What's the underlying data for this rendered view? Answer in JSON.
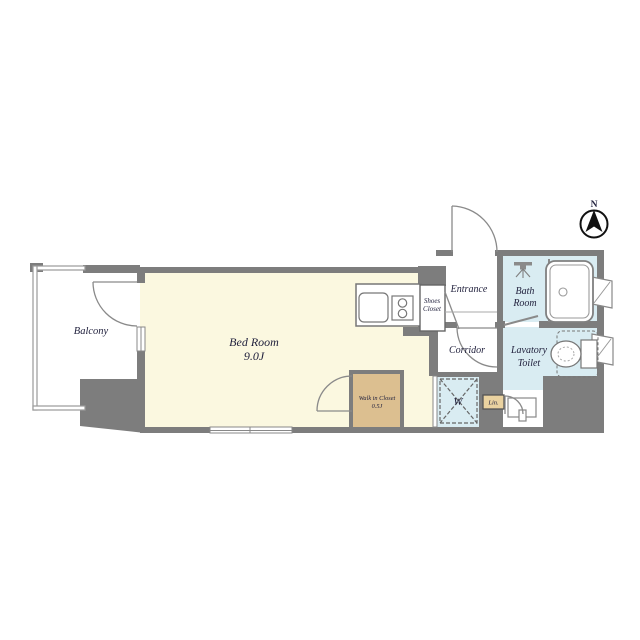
{
  "compass": {
    "label": "N"
  },
  "rooms": {
    "balcony": {
      "label": "Balcony"
    },
    "bedroom": {
      "label": "Bed Room",
      "size": "9.0J"
    },
    "walk_in_closet": {
      "line1": "Walk in Closet",
      "line2": "0.5J"
    },
    "shoes_closet": {
      "line1": "Shoes",
      "line2": "Closet"
    },
    "entrance": {
      "label": "Entrance"
    },
    "bath_room": {
      "line1": "Bath",
      "line2": "Room"
    },
    "corridor": {
      "label": "Corridor"
    },
    "lavatory_toilet": {
      "line1": "Lavatory",
      "line2": "Toilet"
    },
    "washing_machine": {
      "label": "W"
    },
    "linen": {
      "label": "Lin."
    }
  },
  "colors": {
    "wall": "#7d7d7d",
    "bedroom_floor": "#fbf8e0",
    "wet_area": "#d9ecf2",
    "closet": "#dcbf90",
    "linen_shelf": "#ead2a0"
  }
}
